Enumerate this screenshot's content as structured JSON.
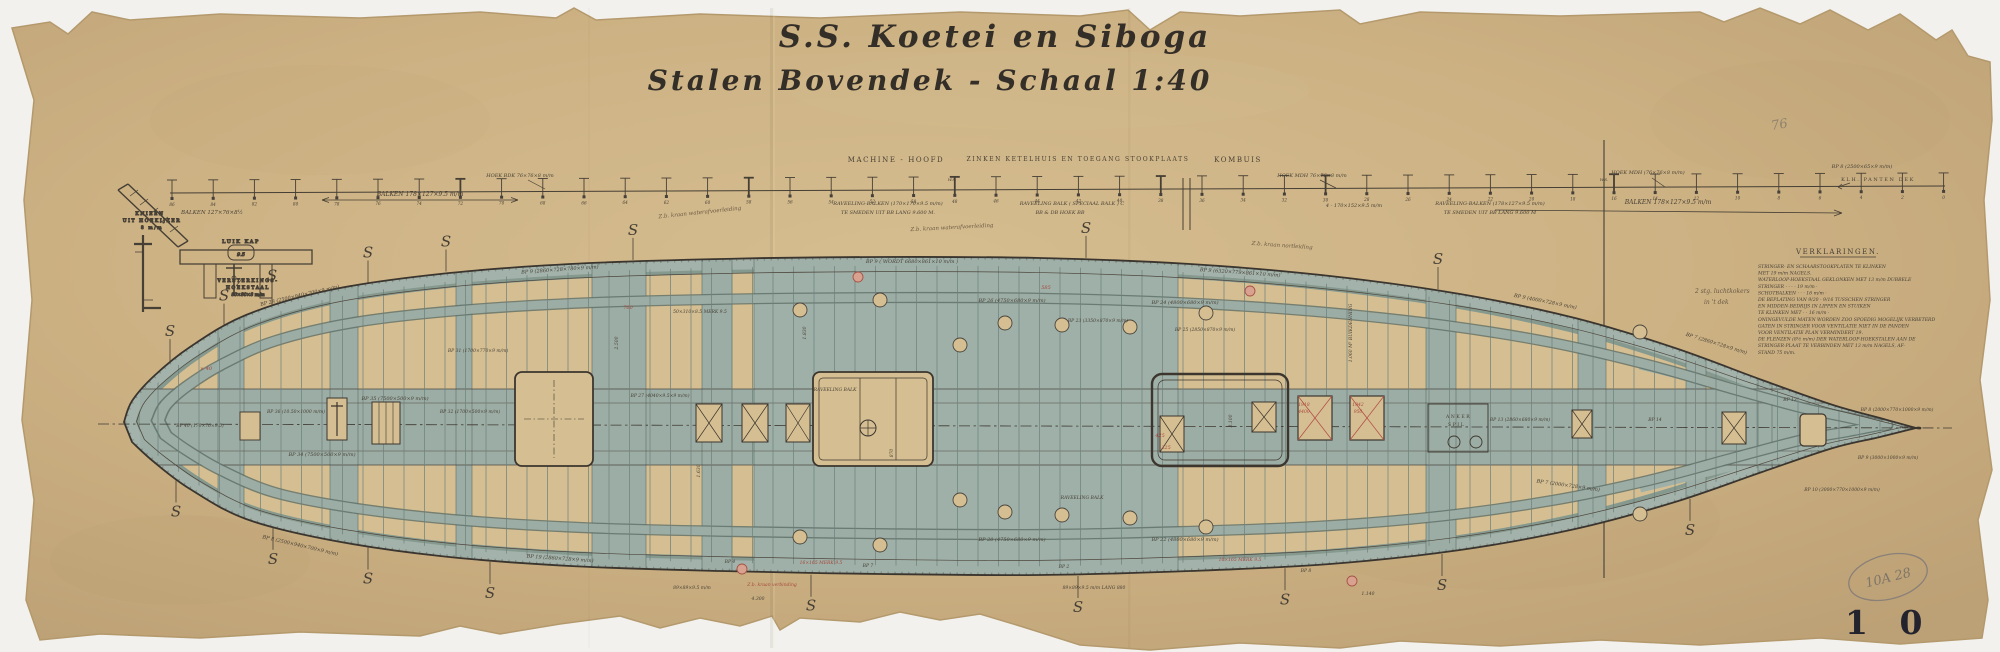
{
  "document": {
    "title_line1": "S.S. Koetei en Siboga",
    "title_line2": "Stalen Bovendek - Schaal 1:40",
    "page_number": "1 0",
    "archive_stamp": "10A 28",
    "pencil_note": "76"
  },
  "colors": {
    "paper": "#ccb183",
    "paper_light": "#d7c094",
    "deck_wash": "#9fb0a8",
    "band": "#93a69f",
    "opening_tan": "#d5bf92",
    "ink": "#463f35",
    "red_ink": "#a8483c",
    "pencil": "#7e7568",
    "scan_background": "#f2f1ee"
  },
  "dimension_line": {
    "frames_first": 86,
    "frames_step": -2,
    "frames_count": 44,
    "labels_above": [
      {
        "x": 520,
        "y": 177,
        "s": 5,
        "text": "HOEK BDK 76×76×8 m/m"
      },
      {
        "x": 896,
        "y": 162,
        "s": 7,
        "caps": true,
        "text": "MACHINE - HOOFD"
      },
      {
        "x": 1078,
        "y": 161,
        "s": 6,
        "caps": true,
        "text": "ZINKEN KETELHUIS EN TOEGANG STOOKPLAATS"
      },
      {
        "x": 1238,
        "y": 162,
        "s": 7,
        "caps": true,
        "text": "KOMBUIS"
      },
      {
        "x": 1312,
        "y": 177,
        "s": 5,
        "text": "HOEK MDH 76×76×8 m/m"
      },
      {
        "x": 1648,
        "y": 174,
        "s": 5,
        "text": "HOEK MDH (76×76×8 m/m)"
      },
      {
        "x": 1862,
        "y": 168,
        "s": 5,
        "text": "BP 8 (2500×65×9 m/m)"
      },
      {
        "x": 1878,
        "y": 181,
        "s": 5,
        "caps": true,
        "text": "KLH. PANTEN DEK"
      },
      {
        "x": 952,
        "y": 181,
        "s": 4,
        "text": "W.S."
      },
      {
        "x": 1604,
        "y": 181,
        "s": 4,
        "text": "W.S."
      }
    ],
    "labels_below": [
      {
        "x": 212,
        "y": 214,
        "s": 5.5,
        "text": "BALKEN 127×76×8½"
      },
      {
        "x": 420,
        "y": 196,
        "s": 6,
        "text": "BALKEN 178×127×9.5 m/m"
      },
      {
        "x": 888,
        "y": 205,
        "s": 5,
        "text": "RAVEELING-BALKEN (170×170×9.5 m/m)"
      },
      {
        "x": 888,
        "y": 214,
        "s": 5,
        "text": "TE SMEDEN UIT BB LANG 9.600 M."
      },
      {
        "x": 1072,
        "y": 205,
        "s": 5,
        "text": "RAVEELING BALK ( SPECIAAL BALK )      C"
      },
      {
        "x": 1060,
        "y": 214,
        "s": 5,
        "text": "BB & DB HOEK BB"
      },
      {
        "x": 1354,
        "y": 207,
        "s": 5,
        "text": "4 - 170×152×9.5 m/m"
      },
      {
        "x": 1490,
        "y": 205,
        "s": 5,
        "text": "RAVEELING-BALKEN (178×127×9.5 m/m)"
      },
      {
        "x": 1490,
        "y": 214,
        "s": 5,
        "text": "TE SMEDEN UIT BB LANG 9.600 M"
      },
      {
        "x": 1668,
        "y": 204,
        "s": 6,
        "text": "BALKEN 178×127×9.5 m/m"
      }
    ]
  },
  "details_left": {
    "knee_label_1": "KNIEËN",
    "knee_label_2": "UIT HOEKIJZER",
    "knee_label_3": "8 m/m",
    "luik_kap": "LUIK KAP",
    "luik_dim": "9.5",
    "verst_1": "VERSTERKINGS-",
    "verst_2": "HOEKSTAAL",
    "verst_3": "80×80×8 m/m"
  },
  "verklaringen": {
    "heading": "VERKLARINGEN.",
    "lines": [
      "STRINGER- EN SCHAARSTOOKPLATEN TE KLINKEN",
      "MET 19 m/m NAGELS.",
      "WATERLOOP-HOEKSTAAL GEKLONKEN MET 13 m/m DUBBELE",
      "STRINGER    ·      ·      ·      ·      19 m/m    ·",
      "SCHOTBALKEN    ·      ·      ·      16 m/m    ·",
      "DE BEPLATING VAN 9/20 - 9/16 TUSSCHEN STRINGER",
      "EN MIDDEN-BEDRIJS IN LIPPEN EN STUIKEN",
      "TE KLINKEN MET    ·      ·      16 m/m    ·",
      "ONINGEVULDE MATEN WORDEN ZOO SPOEDIG MOGELIJK VERBETERD",
      "GATEN IN STRINGER VOOR VENTILATIE NIET IN DE PANDEN",
      "VOOR VENTILATIE PLAN VERMINDERT 19.",
      "DE FLENZEN (8½ m/m) DER WATERLOOP-HOEKSTALEN AAN DE",
      "STRINGER-PLAAT TE VERBINDEN MET 13 m/m NAGELS, AF-",
      "STAND 75 m/m."
    ]
  },
  "side_note": {
    "line1": "2 stg. luchtkokers",
    "line2": "in 't dek"
  },
  "plan": {
    "s_mark_glyph": "S",
    "anchor_label_1": "ANKER",
    "anchor_label_2": "SPIL",
    "annotations": [
      {
        "x": 300,
        "y": 297,
        "r": -13,
        "s": 5,
        "text": "BP 28 (2500×940×700×9 m/m)"
      },
      {
        "x": 560,
        "y": 271,
        "r": -4,
        "s": 5,
        "text": "BP 9 (2860×728×780×9 m/m)"
      },
      {
        "x": 912,
        "y": 263,
        "r": 0,
        "s": 5,
        "text": "BP 9 ( WORDT 6680×861×10 m/m )"
      },
      {
        "x": 1240,
        "y": 274,
        "r": 4,
        "s": 5,
        "text": "BP 9 (6320×779×861×10 m/m)"
      },
      {
        "x": 1545,
        "y": 303,
        "r": 11,
        "s": 5,
        "text": "BP 9 (4000×728×9 m/m)"
      },
      {
        "x": 1716,
        "y": 345,
        "r": 17,
        "s": 5,
        "text": "BP 7 (2860×728×9 m/m)"
      },
      {
        "x": 300,
        "y": 547,
        "r": 13,
        "s": 5,
        "text": "BP 8 (2500×940×700×9 m/m)"
      },
      {
        "x": 560,
        "y": 560,
        "r": 4,
        "s": 5,
        "text": "BP 19 (2860×728×9 m/m)"
      },
      {
        "x": 1568,
        "y": 487,
        "r": 8,
        "s": 5,
        "text": "BP 7 (2000×728×9 m/m)"
      },
      {
        "x": 395,
        "y": 400,
        "r": 0,
        "s": 5,
        "text": "BP 35 (7500×500×9 m/m)"
      },
      {
        "x": 322,
        "y": 456,
        "r": 0,
        "s": 5,
        "text": "BP 34 (7500×500×9 m/m)"
      },
      {
        "x": 296,
        "y": 413,
        "r": 0,
        "s": 4.5,
        "text": "BP 36 (10.50×1000 m/m)"
      },
      {
        "x": 200,
        "y": 427,
        "r": 0,
        "s": 4.5,
        "text": "BP 40 (170×76×9.5)"
      },
      {
        "x": 478,
        "y": 352,
        "r": 0,
        "s": 4.5,
        "text": "BP 31 (1700×770×9 m/m)"
      },
      {
        "x": 470,
        "y": 413,
        "r": 0,
        "s": 4.5,
        "text": "BP 32 (1700×500×9 m/m)"
      },
      {
        "x": 700,
        "y": 313,
        "r": 0,
        "s": 4.5,
        "text": "50×310×8.5 MERK 9.5"
      },
      {
        "x": 1012,
        "y": 302,
        "r": 0,
        "s": 5,
        "text": "BP 26 (4750×680×9 m/m)"
      },
      {
        "x": 1185,
        "y": 304,
        "r": 0,
        "s": 5,
        "text": "BP 24 (4800×680×9 m/m)"
      },
      {
        "x": 1098,
        "y": 322,
        "r": 0,
        "s": 4.5,
        "text": "BP 23 (3350×870×9 m/m)"
      },
      {
        "x": 1205,
        "y": 331,
        "r": 0,
        "s": 4.5,
        "text": "BP 25 (2850×870×9 m/m)"
      },
      {
        "x": 1012,
        "y": 541,
        "r": 0,
        "s": 5,
        "text": "BP 20 (4750×680×9 m/m)"
      },
      {
        "x": 1185,
        "y": 541,
        "r": 0,
        "s": 5,
        "text": "BP 22 (4800×680×9 m/m)"
      },
      {
        "x": 835,
        "y": 391,
        "r": 0,
        "s": 4.5,
        "text": "RAVEELING BALK"
      },
      {
        "x": 1082,
        "y": 499,
        "r": 0,
        "s": 4.5,
        "text": "RAVEELING BALK"
      },
      {
        "x": 660,
        "y": 397,
        "r": 0,
        "s": 4.5,
        "text": "BP 27 (4040×9.5×9 m/m)"
      },
      {
        "x": 1352,
        "y": 333,
        "r": -90,
        "s": 4.5,
        "text": "1.060 M³ BUIKDENNING"
      },
      {
        "x": 618,
        "y": 343,
        "r": -90,
        "s": 4.5,
        "text": "2.500"
      },
      {
        "x": 806,
        "y": 333,
        "r": -90,
        "s": 4.5,
        "text": "1.830"
      },
      {
        "x": 700,
        "y": 471,
        "r": -90,
        "s": 4.5,
        "text": "1.630"
      },
      {
        "x": 1232,
        "y": 421,
        "r": -90,
        "s": 4.5,
        "text": "3.100"
      },
      {
        "x": 893,
        "y": 453,
        "r": -90,
        "s": 4.5,
        "text": "870"
      },
      {
        "x": 1520,
        "y": 421,
        "r": 0,
        "s": 4.5,
        "text": "BP 13 (2860×680×9 m/m)"
      },
      {
        "x": 1655,
        "y": 421,
        "r": 0,
        "s": 4.5,
        "text": "BP 14"
      },
      {
        "x": 1790,
        "y": 401,
        "r": 0,
        "s": 4.5,
        "text": "BP 13"
      },
      {
        "x": 1897,
        "y": 411,
        "r": 0,
        "s": 4.5,
        "text": "BP 8 (2000×770×1000×9 m/m)"
      },
      {
        "x": 1888,
        "y": 459,
        "r": 0,
        "s": 4.5,
        "text": "BP 9 (3000×1000×9 m/m)"
      },
      {
        "x": 1842,
        "y": 491,
        "r": 0,
        "s": 4.5,
        "text": "BP 10 (3000×770×1000×9 m/m)"
      },
      {
        "x": 868,
        "y": 567,
        "r": 0,
        "s": 4.5,
        "text": "BP 7"
      },
      {
        "x": 1064,
        "y": 568,
        "r": 0,
        "s": 4.5,
        "text": "BP 2"
      },
      {
        "x": 1306,
        "y": 572,
        "r": 0,
        "s": 4.5,
        "text": "BP 8"
      },
      {
        "x": 730,
        "y": 563,
        "r": 0,
        "s": 4.5,
        "text": "BP 4"
      },
      {
        "x": 692,
        "y": 589,
        "r": 0,
        "s": 4.5,
        "text": "89×89×9.5 m/m"
      },
      {
        "x": 1094,
        "y": 589,
        "r": 0,
        "s": 4.5,
        "text": "89×89×9.5 m/m  LANG 880"
      },
      {
        "x": 758,
        "y": 600,
        "r": 0,
        "s": 4.5,
        "text": "4.300"
      },
      {
        "x": 1368,
        "y": 595,
        "r": 0,
        "s": 4.5,
        "text": "1.140"
      }
    ],
    "script_notes": [
      {
        "x": 700,
        "y": 214,
        "r": -6,
        "s": 5.5,
        "text": "Z.b. kraan waterafvoerleiding"
      },
      {
        "x": 952,
        "y": 229,
        "r": -3,
        "s": 5.5,
        "text": "Z.b. kraan waterafvoerleiding"
      },
      {
        "x": 1282,
        "y": 247,
        "r": 4,
        "s": 5.5,
        "text": "Z.b. kraan nortleiding"
      }
    ],
    "red_annotations": [
      {
        "x": 1046,
        "y": 289,
        "s": 5,
        "text": "585"
      },
      {
        "x": 1160,
        "y": 437,
        "s": 5,
        "text": "425"
      },
      {
        "x": 1166,
        "y": 449,
        "s": 5,
        "text": "325"
      },
      {
        "x": 206,
        "y": 370,
        "s": 5,
        "text": "× 40"
      },
      {
        "x": 628,
        "y": 309,
        "s": 5,
        "text": "760"
      },
      {
        "x": 1304,
        "y": 406,
        "s": 4.5,
        "text": "1918"
      },
      {
        "x": 1304,
        "y": 413,
        "s": 4.5,
        "text": "4400"
      },
      {
        "x": 1358,
        "y": 406,
        "s": 4.5,
        "text": "1942"
      },
      {
        "x": 1358,
        "y": 413,
        "s": 4.5,
        "text": "950"
      },
      {
        "x": 821,
        "y": 564,
        "s": 4.5,
        "text": "16×165 MERK 9.5"
      },
      {
        "x": 1240,
        "y": 561,
        "s": 4.5,
        "text": "16×165 MERK 9.5"
      },
      {
        "x": 772,
        "y": 586,
        "s": 4.5,
        "text": "Z.b. kraan verbinding"
      }
    ]
  }
}
